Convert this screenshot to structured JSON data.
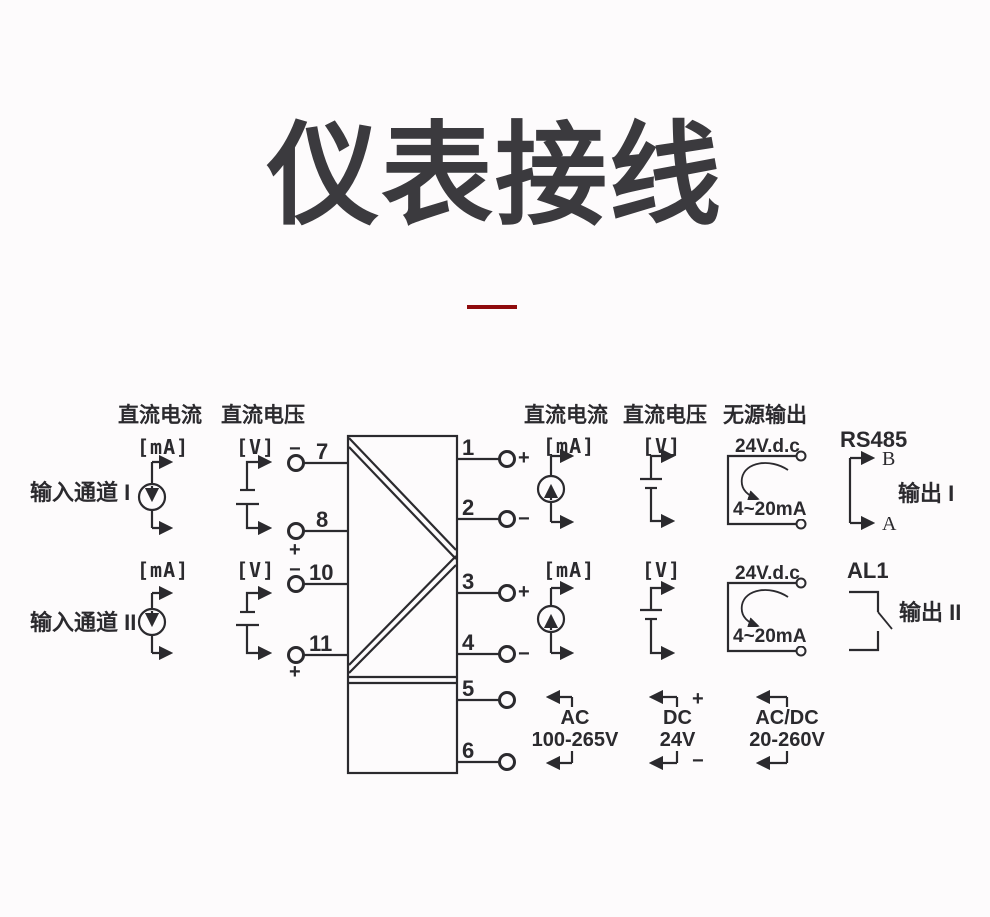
{
  "colors": {
    "bg": "#fdfbfc",
    "ink": "#2b2a2e",
    "accent": "#8f0b0d",
    "title": "#3b3a3e"
  },
  "title": "仪表接线",
  "headers": {
    "input_current": "直流电流",
    "input_voltage": "直流电压",
    "output_current": "直流电流",
    "output_voltage": "直流电压",
    "passive_output": "无源输出",
    "rs485": "RS485"
  },
  "inputs": [
    {
      "label": "输入通道 I",
      "current_unit": "[mA]",
      "voltage_unit": "[V]",
      "neg": "−",
      "pos": "+",
      "terminal_neg": "7",
      "terminal_pos": "8"
    },
    {
      "label": "输入通道 II",
      "current_unit": "[mA]",
      "voltage_unit": "[V]",
      "neg": "−",
      "pos": "+",
      "terminal_neg": "10",
      "terminal_pos": "11"
    }
  ],
  "right_terminals": {
    "t1": "1",
    "t2": "2",
    "t3": "3",
    "t4": "4",
    "t5": "5",
    "t6": "6"
  },
  "outputs": [
    {
      "label": "输出 I",
      "current_unit": "[mA]",
      "voltage_unit": "[V]",
      "pos": "+",
      "neg": "−",
      "passive_voltage": "24V.d.c",
      "passive_range": "4~20mA",
      "comm_b": "B",
      "comm_a": "A"
    },
    {
      "label": "输出 II",
      "current_unit": "[mA]",
      "voltage_unit": "[V]",
      "pos": "+",
      "neg": "−",
      "passive_voltage": "24V.d.c",
      "passive_range": "4~20mA",
      "alarm": "AL1"
    }
  ],
  "power": {
    "pos": "+",
    "neg": "−",
    "options": [
      {
        "line1": "AC",
        "line2": "100-265V"
      },
      {
        "line1": "DC",
        "line2": "24V"
      },
      {
        "line1": "AC/DC",
        "line2": "20-260V"
      }
    ]
  }
}
